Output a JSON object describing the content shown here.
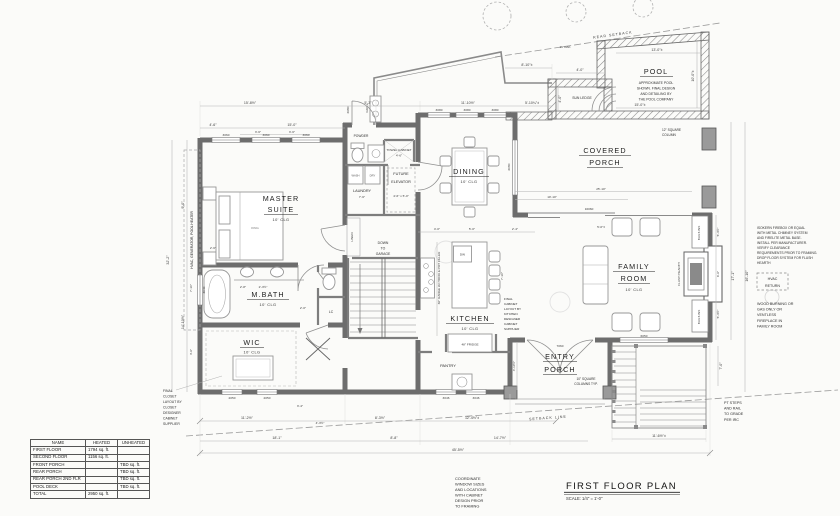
{
  "title_block": {
    "title": "FIRST FLOOR PLAN",
    "scale": "SCALE:  1/4\" = 1'-0\""
  },
  "area_table": {
    "headers": [
      "NAME",
      "HEATED",
      "UNHEATED"
    ],
    "rows": [
      {
        "name": "FIRST FLOOR",
        "heated": "1794 sq. ft.",
        "unheated": ""
      },
      {
        "name": "SECOND FLOOR",
        "heated": "1156 sq. ft.",
        "unheated": ""
      },
      {
        "name": "FRONT PORCH",
        "heated": "",
        "unheated": "TBD sq. ft."
      },
      {
        "name": "REAR PORCH",
        "heated": "",
        "unheated": "TBD sq. ft."
      },
      {
        "name": "REAR PORCH 2ND FLR",
        "heated": "",
        "unheated": "TBD sq. ft."
      },
      {
        "name": "POOL DECK",
        "heated": "",
        "unheated": "TBD sq. ft."
      },
      {
        "name": "TOTAL",
        "heated": "2950 sq. ft.",
        "unheated": ""
      }
    ]
  },
  "rooms": {
    "master_suite": {
      "line1": "MASTER",
      "line2": "SUITE",
      "clg": "10' CLG",
      "bed": "KING"
    },
    "m_bath": {
      "name": "M.BATH",
      "clg": "10' CLG"
    },
    "wic": {
      "name": "WIC",
      "clg": "10' CLG"
    },
    "dining": {
      "name": "DINING",
      "clg": "10' CLG"
    },
    "kitchen": {
      "name": "KITCHEN",
      "clg": "10' CLG"
    },
    "family_room": {
      "line1": "FAMILY",
      "line2": "ROOM",
      "clg": "10' CLG"
    },
    "covered_porch": {
      "line1": "COVERED",
      "line2": "PORCH"
    },
    "entry_porch": {
      "line1": "ENTRY",
      "line2": "PORCH"
    },
    "pool": {
      "name": "POOL",
      "note1": "APPROXIMATE POOL",
      "note2": "SHOWN. FINAL DESIGN",
      "note3": "AND DETAILING BY",
      "note4": "THE POOL COMPANY"
    },
    "sun_ledge": "SUN LEDGE",
    "powder": "POWDER",
    "laundry": {
      "name": "LAUNDRY",
      "dim": "7'-6\""
    },
    "wash": "WASH",
    "dry": "DRY",
    "pantry": "PANTRY",
    "linen": "LINEN",
    "lc": "LC",
    "future_elevator": {
      "line1": "FUTURE",
      "line2": "ELEVATOR",
      "size": "4'-6\" x 5'-0\""
    },
    "towel_cabinet": {
      "line1": "TOWEL CABINET",
      "line2": "4'-6\""
    },
    "down_to_garage": {
      "line1": "DOWN",
      "line2": "TO",
      "line3": "GARAGE"
    },
    "grill": "GRILL",
    "hvac_pad": "HVAC, GENERATOR, POOL HEATER",
    "fridge": "48\" FRIDGE",
    "dw": "DW",
    "range_note": "36\" RANGE W/ HOOD & POT FILLER",
    "flush_hearth": "FLUSH HEARTH",
    "built_ins": "BUILT-INS"
  },
  "notes": {
    "rear_setback": "REAR SETBACK",
    "setback_line": "SETBACK LINE",
    "oak_tree": "16\"OAK",
    "column_12": {
      "line1": "12\" SQUARE",
      "line2": "COLUMN"
    },
    "columns_10": {
      "line1": "10\" SQUARE",
      "line2": "COLUMNS TYP."
    },
    "cabinet_layout": [
      "FINAL",
      "CABINET",
      "LAYOUT BY",
      "KITCHEN",
      "DESIGNER",
      "CABINET",
      "SUPPLIER"
    ],
    "closet_layout": [
      "FINAL",
      "CLOSET",
      "LAYOUT BY",
      "CLOSET",
      "DESIGNER",
      "CABINET",
      "SUPPLIER"
    ],
    "fireplace_spec": [
      "ISOKERN FIREBOX OR EQUAL",
      "WITH METAL CHIMNEY SYSTEM",
      "AND FIRELITE METAL BASE.",
      "INSTALL PER MANUFACTURER.",
      "VERIFY CLEARANCE",
      "REQUIREMENTS PRIOR TO FRAMING.",
      "DROP FLOOR SYSTEM FOR FLUSH",
      "HEARTH"
    ],
    "hvac_return": {
      "line1": "HVAC",
      "line2": "RETURN"
    },
    "wood_burning": [
      "WOOD BURNING OR",
      "GAS ONLY OR",
      "VENTLESS",
      "FIREPLACE IN",
      "FAMILY ROOM"
    ],
    "pt_steps": [
      "PT STEPS",
      "AND RAIL",
      "TO GRADE",
      "PER IRC"
    ],
    "coordinate": [
      "COORDINATE",
      "WINDOW SIZES",
      "AND LOCATIONS",
      "WITH CABINET",
      "DESIGN PRIOR",
      "TO FRAMING"
    ]
  },
  "dims": {
    "top": [
      "15'-8½\"",
      "5'-3\"",
      "4'-6\"",
      "15'-0\"",
      "3'-6\"",
      "3'-6\"",
      "11'-10½\"",
      "5'-10¼\"±",
      "8'-10\"±"
    ],
    "pool": [
      "4'-0\"",
      "13'-0\"±",
      "10'-0\"±",
      "15'-0\"±",
      "4'-0\""
    ],
    "left": [
      "32'-2\"",
      "9'-0\"",
      "7'-10\"",
      "14'-10½\"",
      "4'-6\"",
      "2'-6\""
    ],
    "right": [
      "5'-3½\"",
      "6'-6\"",
      "5'-3½\"",
      "17'-1\"",
      "16'-10\"",
      "7'-0\""
    ],
    "bottom": [
      "11'-2½\"",
      "4'-3½\"",
      "8'-3½\"",
      "12'-4½\"±",
      "18'-1\"",
      "8'-8\"",
      "14'-7½\"",
      "45'-5½\"",
      "11'-6½\"±",
      "3'-4\""
    ],
    "interior": [
      "10'-10\"",
      "25'-10\"",
      "4'-0\"",
      "5'-0\"",
      "2'-4\"",
      "7'-10\"",
      "2'-8\"",
      "2'-3½\"",
      "2'-0\"",
      "5'-0\"±",
      "4'-10½\""
    ]
  },
  "openings": {
    "master_windows": [
      "3060",
      "3060",
      "3060"
    ],
    "dining_windows": [
      "3080",
      "3080",
      "3080"
    ],
    "rear_door": "2680",
    "porch_slider": "16060",
    "dining_slider": "6080",
    "entry_door": "7060",
    "family_window": "6050",
    "pantry_windows": [
      "3046",
      "3046"
    ],
    "wic_windows": [
      "2050",
      "2050"
    ],
    "bath_window": "3040"
  }
}
